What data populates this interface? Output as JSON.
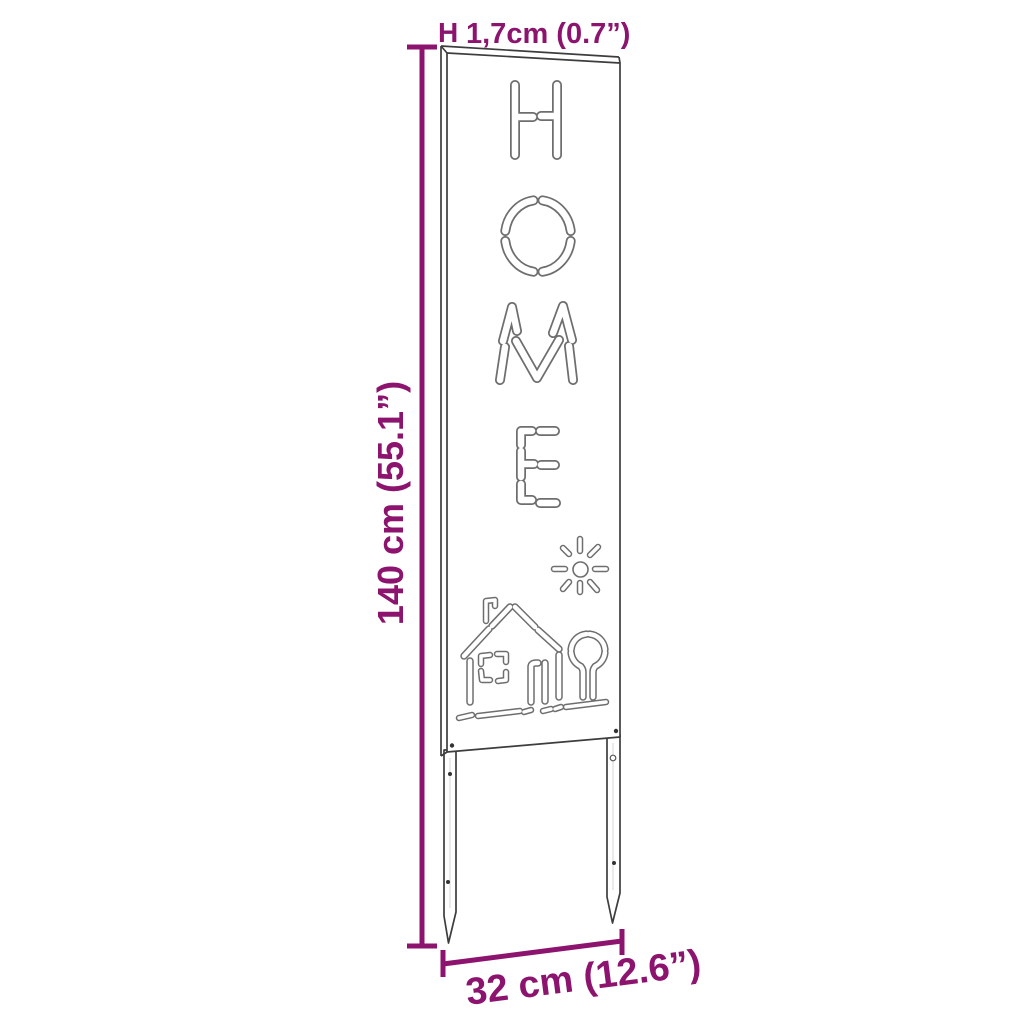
{
  "diagram": {
    "type": "product-dimension-diagram",
    "product": "Garden stake sign with HOME stencil cut-out, sun, house and tree motif",
    "background_color": "#ffffff",
    "accent_color": "#8C146E",
    "line_color": "#3d3d3d",
    "cutout_word": "HOME",
    "motifs": [
      "letter-H",
      "letter-O",
      "letter-M",
      "letter-E",
      "sun",
      "house-with-chimney-window-door",
      "tree",
      "ground-strips",
      "two-ground-stakes"
    ],
    "dimensions": {
      "thickness": {
        "marker": "H",
        "label": "1,7cm (0.7”)"
      },
      "height": {
        "label": "140 cm (55.1”)"
      },
      "width": {
        "label": "32 cm (12.6”)"
      }
    }
  }
}
